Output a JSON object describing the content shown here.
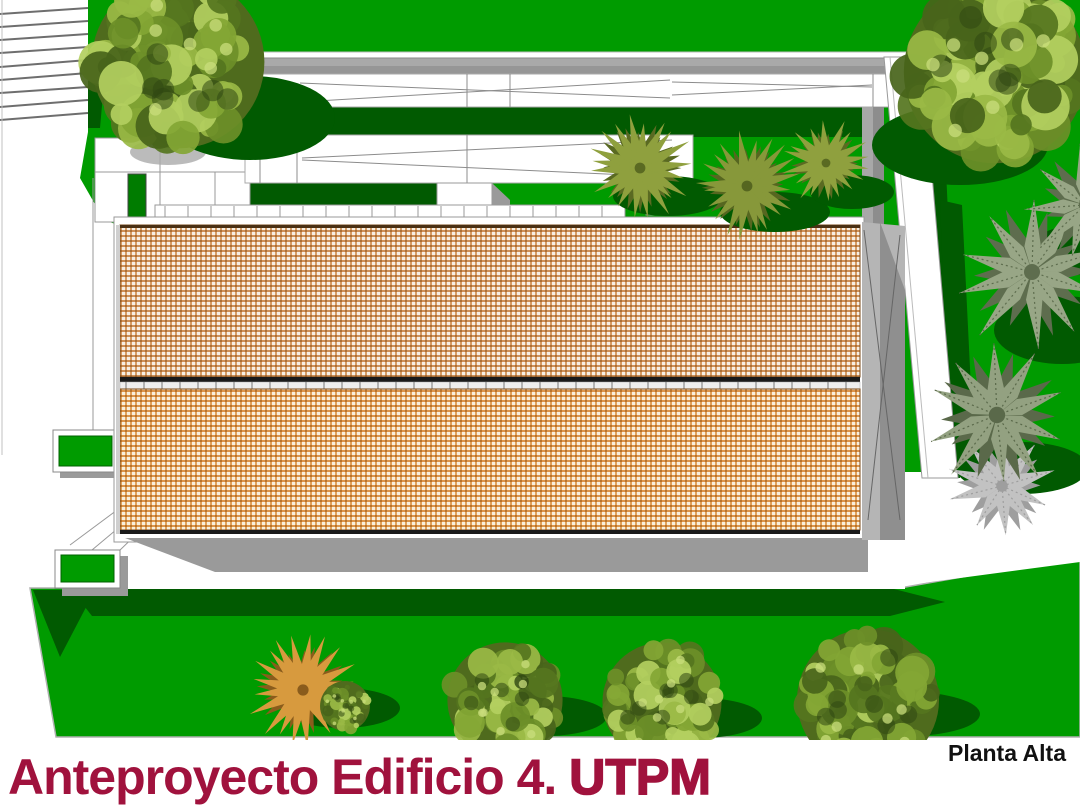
{
  "caption": {
    "project_title": "Anteproyecto Edificio 4.",
    "org_acronym": "UTPM",
    "plan_label": "Planta Alta"
  },
  "palette": {
    "grass": "#009b00",
    "grass_shadow": "#015a01",
    "roof_tile_orange": "#d79c63",
    "path_white": "#ffffff",
    "ramp_gray": "#a9a9a9",
    "wall_gray": "#8f8f8f",
    "title_maroon": "#a0123d",
    "label_black": "#111111"
  }
}
